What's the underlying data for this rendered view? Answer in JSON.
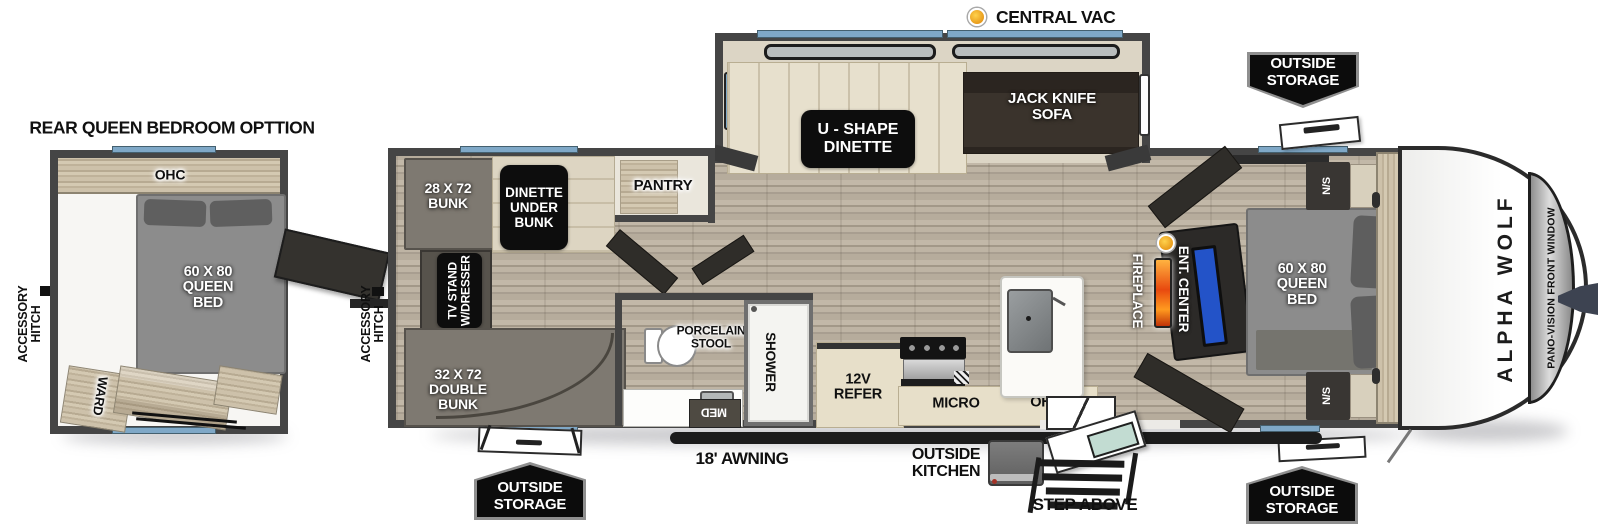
{
  "annotations": {
    "central_vac": "CENTRAL VAC",
    "awning": "18' AWNING",
    "outside_kitchen": "OUTSIDE\nKITCHEN",
    "step_above": "STEP ABOVE",
    "outside_storage": "OUTSIDE\nSTORAGE"
  },
  "rear_option": {
    "title": "REAR QUEEN BEDROOM OPTTION",
    "accessory_hitch": "ACCESSORY\nHITCH",
    "ohc": "OHC",
    "queen_bed": "60 X 80\nQUEEN\nBED",
    "ward": "WARD"
  },
  "main": {
    "accessory_hitch": "ACCESSORY\nHITCH",
    "bunk": "28 X 72\nBUNK",
    "dinette_under_bunk": "DINETTE\nUNDER\nBUNK",
    "pantry": "PANTRY",
    "u_shape_dinette": "U - SHAPE\nDINETTE",
    "jack_knife_sofa": "JACK KNIFE\nSOFA",
    "tv_stand": "TV STAND\nW/DRESSER",
    "double_bunk": "32 X 72\nDOUBLE\nBUNK",
    "porcelain_stool": "PORCELAIN\nSTOOL",
    "shower": "SHOWER",
    "med": "MED",
    "refer": "12V\nREFER",
    "micro": "MICRO",
    "kitchen_ohc": "OHC",
    "fireplace": "FIREPLACE",
    "ent_center": "ENT. CENTER",
    "queen_bed": "60 X 80\nQUEEN\nBED",
    "ns_top": "N/S",
    "ns_bottom": "N/S",
    "ward_top": "WARD",
    "ward_bottom": "WARD",
    "front_ohc": "OHC",
    "brand": "ALPHA WOLF",
    "pano_window": "PANO-VISION FRONT WINDOW"
  },
  "colors": {
    "wall": "#454545",
    "window_blue": "#7fa8c7",
    "floor_wood": "#b6ac9c",
    "cabinet_wood": "#c9bda6",
    "bed_gray": "#8c8c8c",
    "sofa_dark": "#3a332c",
    "chip_black": "#0d0d0d",
    "tv_blue": "#2353c8",
    "flame_orange": "#e8490f",
    "vac_dot_yellow": "#f2a31d",
    "badge_border": "#8f8f8f"
  }
}
